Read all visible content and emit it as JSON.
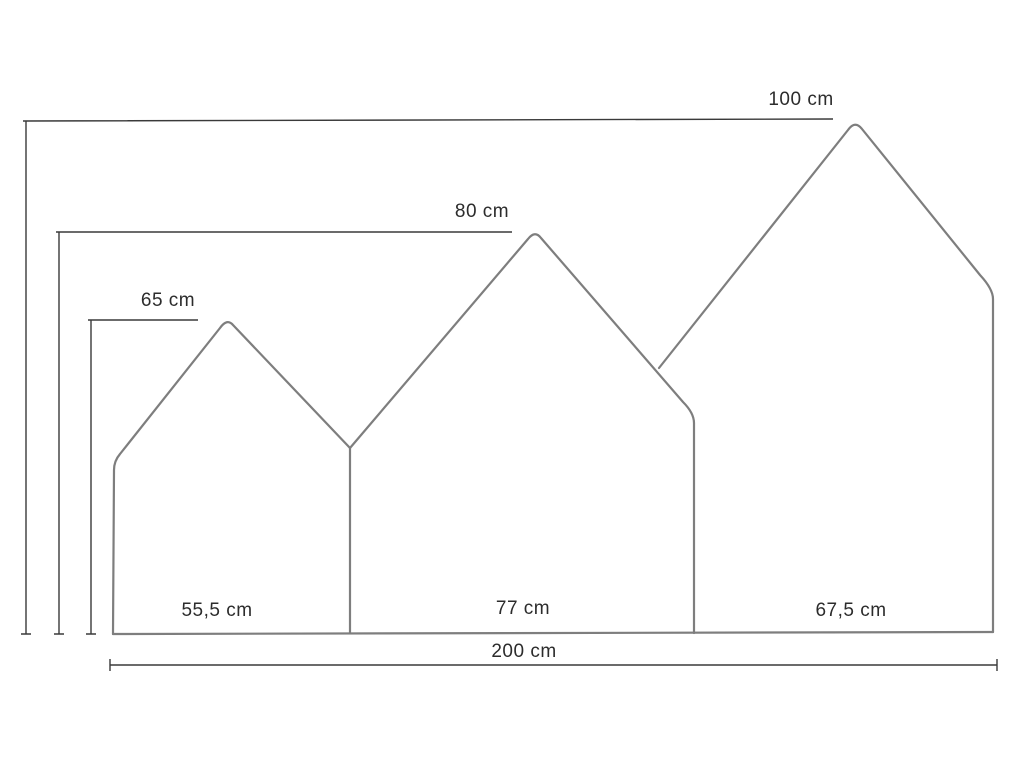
{
  "diagram": {
    "type": "technical-dimension-drawing",
    "subject": "three house-shaped panels with measurements",
    "background_color": "#ffffff",
    "panel_outline_color": "#7e7e7e",
    "dimension_line_color": "#3a3a3a",
    "label_color": "#2c2c2c",
    "unit": "cm",
    "panels": [
      {
        "name": "left-panel",
        "height_label": "65 cm",
        "height_cm": 65,
        "width_label": "55,5 cm",
        "width_cm": 55.5
      },
      {
        "name": "middle-panel",
        "height_label": "80 cm",
        "height_cm": 80,
        "width_label": "77 cm",
        "width_cm": 77
      },
      {
        "name": "right-panel",
        "height_label": "100 cm",
        "height_cm": 100,
        "width_label": "67,5 cm",
        "width_cm": 67.5
      }
    ],
    "total_width": {
      "label": "200 cm",
      "value_cm": 200
    }
  }
}
